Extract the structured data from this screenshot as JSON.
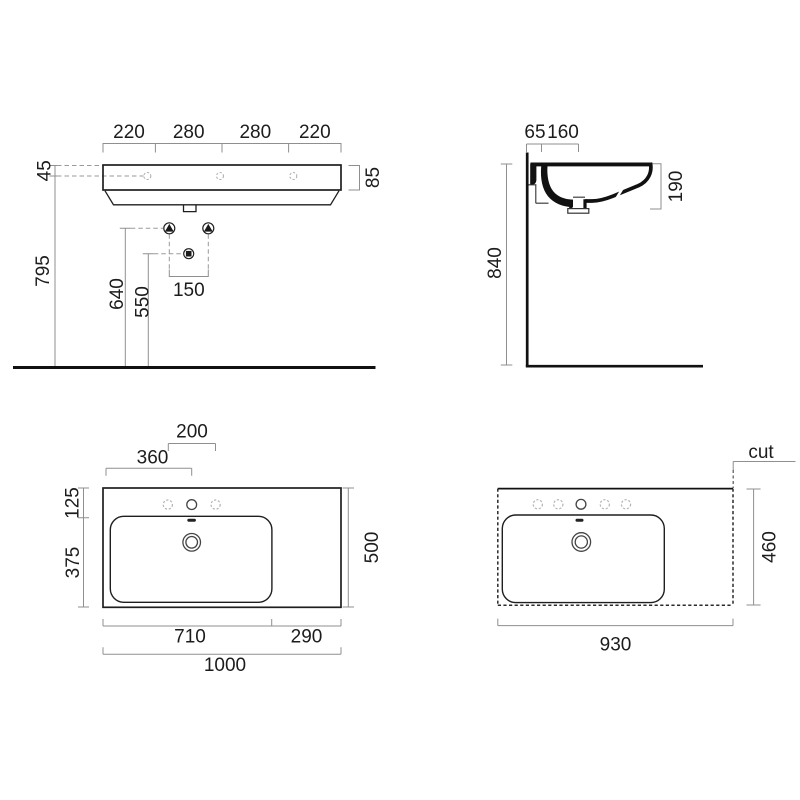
{
  "title": "washbasin-technical-drawing",
  "colors": {
    "background": "#ffffff",
    "drawing_line": "#1f1f1f",
    "dimension_line": "#8f8f8f",
    "dashed_detail": "#b3b3b3",
    "text": "#1c1c1c"
  },
  "front_view": {
    "width_segments": [
      "220",
      "280",
      "280",
      "220"
    ],
    "rim_offset": "45",
    "rim_height": "85",
    "floor_height": "795",
    "fixing_height": "640",
    "drain_height": "550",
    "fixing_spacing": "150"
  },
  "side_view": {
    "wall_offset": "65",
    "tap_offset": "160",
    "basin_depth": "190",
    "mount_height": "840"
  },
  "plan_view": {
    "tap_spacing": "200",
    "tap_center": "360",
    "front_edge": "125",
    "basin_depth": "375",
    "total_depth": "500",
    "basin_width": "710",
    "shelf_width": "290",
    "total_width": "1000"
  },
  "cut_view": {
    "label": "cut",
    "depth": "460",
    "width": "930"
  }
}
